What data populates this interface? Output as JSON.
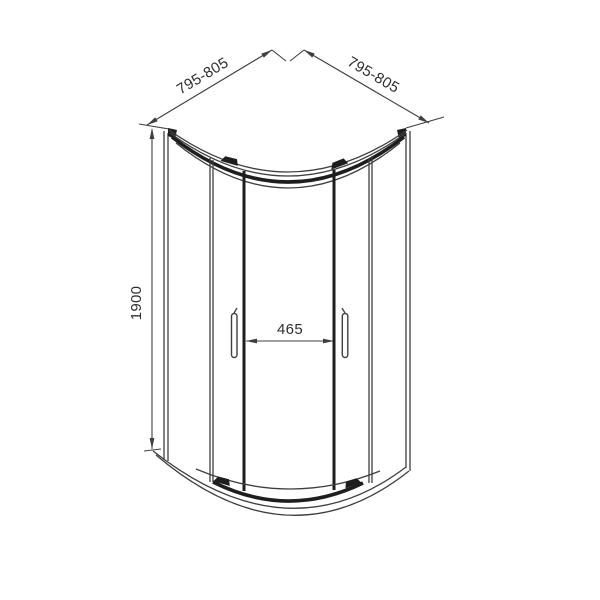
{
  "drawing": {
    "colors": {
      "line": "#3f3f3f",
      "dark": "#1e1e1e",
      "text": "#2e2e2e",
      "background": "#ffffff"
    },
    "labels": {
      "width_left": "795-805",
      "width_right": "795-805",
      "height": "1900",
      "door_opening": "465"
    }
  }
}
